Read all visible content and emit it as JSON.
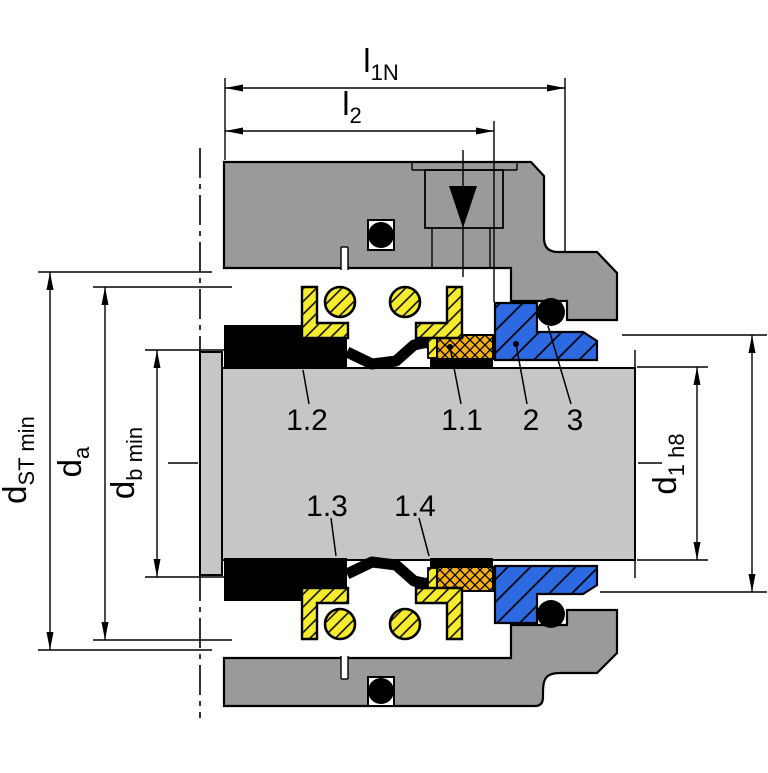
{
  "diagram": {
    "dimension_labels": {
      "l1n": {
        "main": "l",
        "sub": "1N"
      },
      "l2": {
        "main": "l",
        "sub": "2"
      },
      "dst_min": {
        "main": "d",
        "sub": "ST min"
      },
      "da": {
        "main": "d",
        "sub": "a"
      },
      "db_min": {
        "main": "d",
        "sub": "b min"
      },
      "d1_h8": {
        "main": "d",
        "sub": "1 h8"
      }
    },
    "part_labels": {
      "p1_1": "1.1",
      "p1_2": "1.2",
      "p1_3": "1.3",
      "p1_4": "1.4",
      "p2": "2",
      "p3": "3"
    },
    "colors": {
      "housing": "#9a9a9a",
      "shaft": "#c6c6c6",
      "seat": "#2d69e1",
      "spring": "#f5ec2f",
      "face": "#f5b117",
      "line": "#000000",
      "bg": "#ffffff"
    }
  }
}
